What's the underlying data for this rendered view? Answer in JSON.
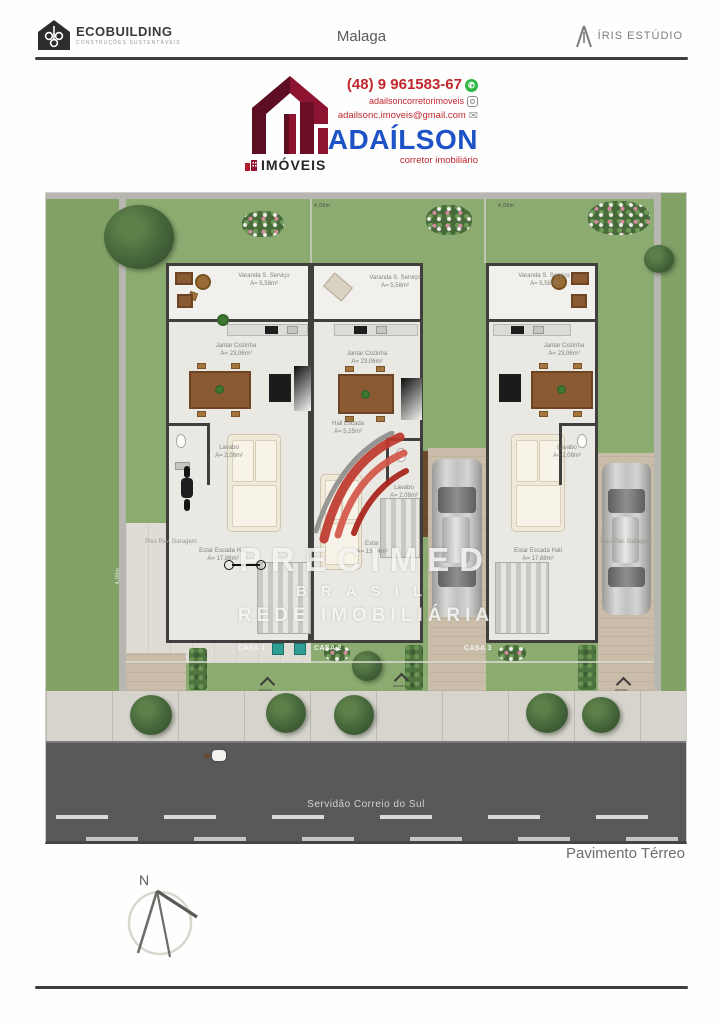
{
  "header": {
    "brand_left": {
      "name": "ECOBUILDING",
      "tagline": "CONSTRUÇÕES SUSTENTÁVEIS"
    },
    "project_title": "Malaga",
    "brand_right": "ÍRIS ESTÚDIO"
  },
  "contact": {
    "phone": "(48) 9 961583-67",
    "instagram": "adailsoncorretorimoveis",
    "email": "adailsonc.imoveis@gmail.com",
    "agent_name": "ADAÍLSON",
    "agent_title": "corretor imobiliário",
    "agency_label": "IMÓVEIS"
  },
  "plan": {
    "floor_label": "Pavimento Térreo",
    "street_name": "Servidão Correio do Sul",
    "watermark": {
      "line1": "PRECIMED",
      "line2": "BRASIL",
      "line3": "REDE IMOBILIÁRIA"
    },
    "houses": [
      {
        "name": "CASA 1"
      },
      {
        "name": "CASA 2"
      },
      {
        "name": "CASA 3"
      }
    ],
    "rooms": {
      "varanda": {
        "name": "Varanda S. Serviço",
        "area": "A= 5,58m²"
      },
      "jantar": {
        "name": "Jantar Cozinha",
        "area": "A= 23,06m²"
      },
      "lavabo": {
        "name": "Lavabo",
        "area": "A= 2,08m²"
      },
      "estar_escada": {
        "name": "Estar Escada Hall",
        "area": "A= 17,88m²"
      },
      "hall_escada": {
        "name": "Hall Escada",
        "area": "A= 5,25m²"
      },
      "estar": {
        "name": "Estar",
        "area": "A= 13,74m²"
      }
    },
    "garage_floor_label": "Piso Pav. Garagem",
    "access_label": "acesso",
    "dimension_label": "4,00m"
  },
  "compass": {
    "north": "N"
  },
  "colors": {
    "brand_red": "#c0272d",
    "brand_blue": "#1d53c6",
    "logo_maroon": "#7a1230",
    "whatsapp_green": "#2bb741",
    "grass": "#8bab70",
    "street": "#59595b"
  }
}
